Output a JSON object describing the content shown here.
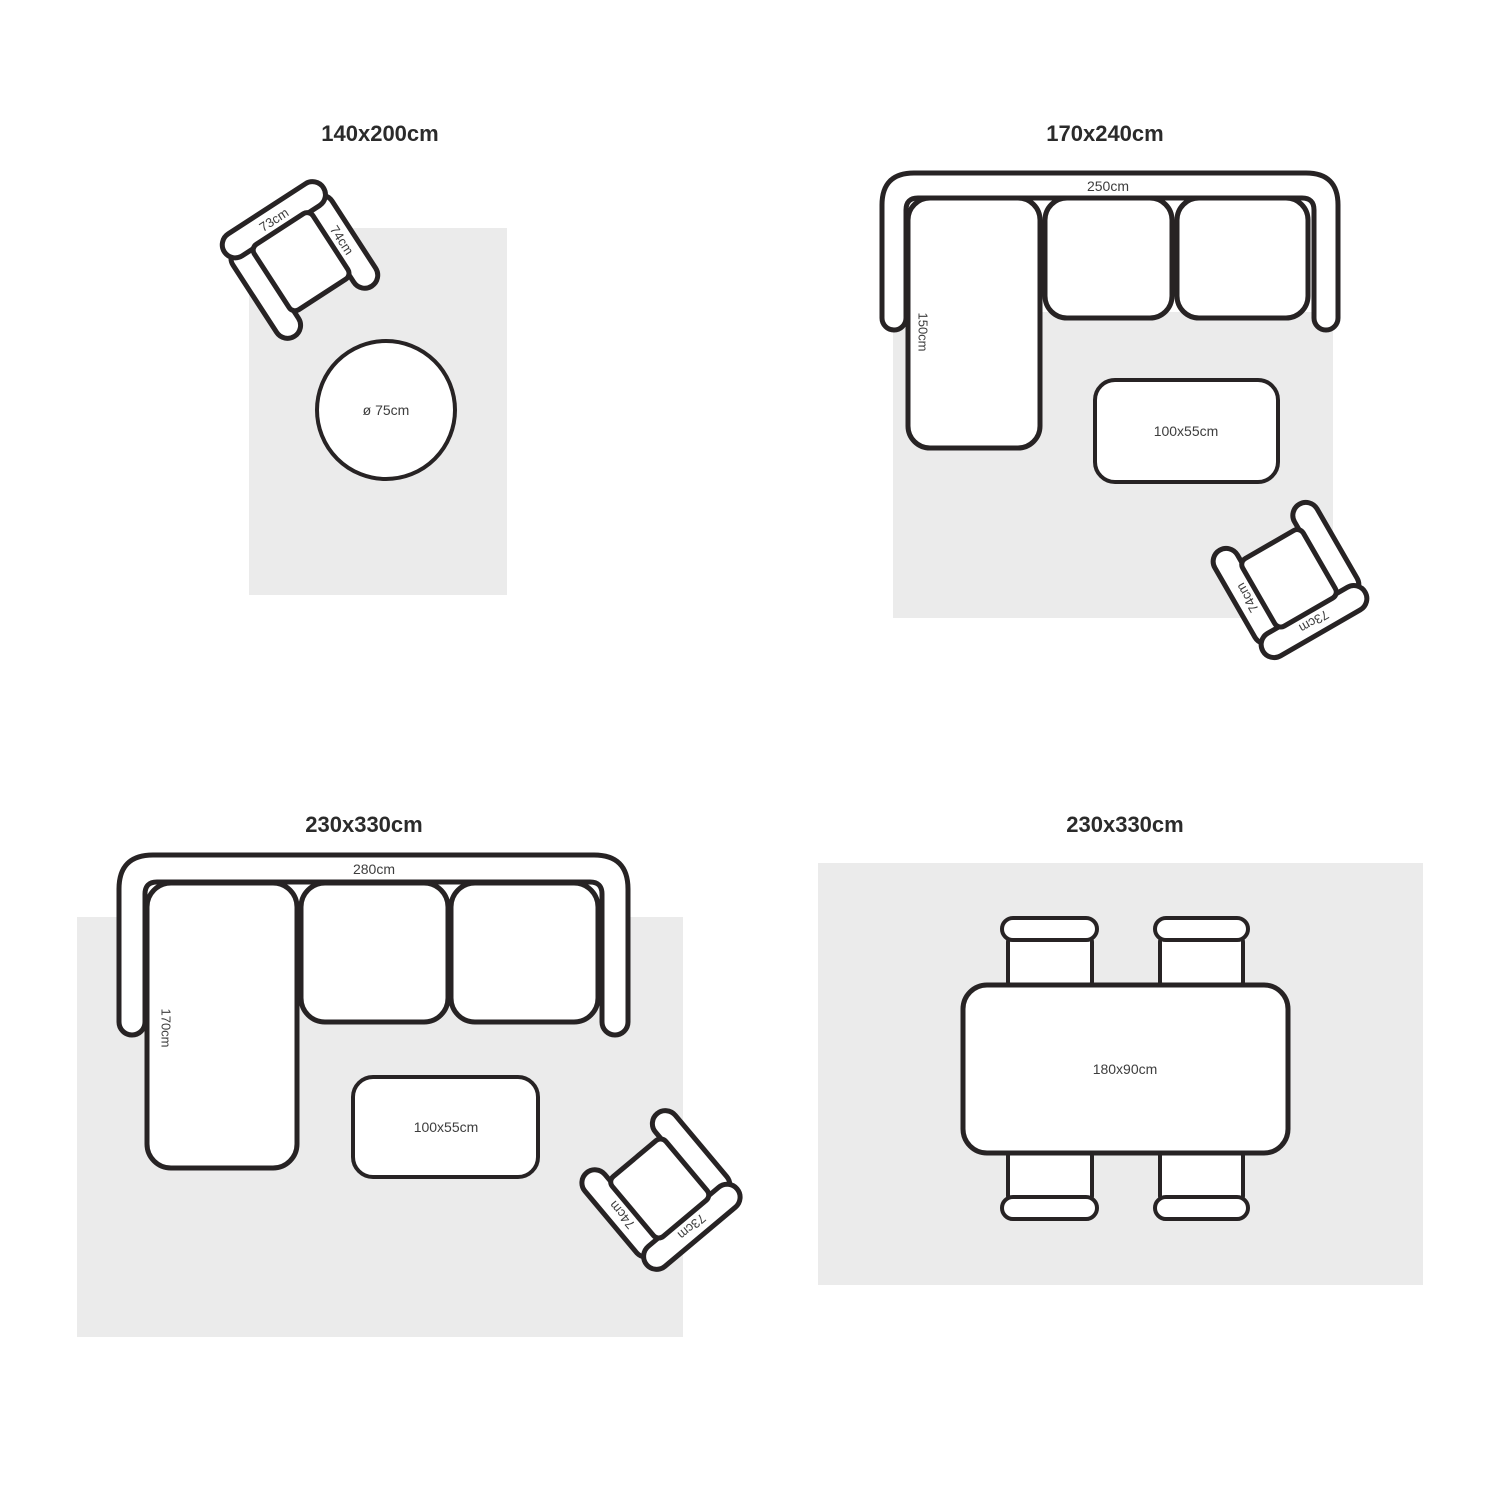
{
  "page": {
    "description": "Rug size guide diagrams with furniture layouts",
    "colors": {
      "background": "#ffffff",
      "rug": "#ebebeb",
      "line": "#272324",
      "label": "#3d3d3d",
      "title": "#2b2b2b"
    }
  },
  "quadrants": [
    {
      "title": "140x200cm",
      "armchair": {
        "back_label": "73cm",
        "arm_label": "74cm"
      },
      "round_table": {
        "label": "ø 75cm"
      }
    },
    {
      "title": "170x240cm",
      "sofa": {
        "width_label": "250cm",
        "chaise_label": "150cm"
      },
      "coffee_table": {
        "label": "100x55cm"
      },
      "armchair": {
        "back_label": "73cm",
        "arm_label": "74cm"
      }
    },
    {
      "title": "230x330cm",
      "sofa": {
        "width_label": "280cm",
        "chaise_label": "170cm"
      },
      "coffee_table": {
        "label": "100x55cm"
      },
      "armchair": {
        "back_label": "73cm",
        "arm_label": "74cm"
      }
    },
    {
      "title": "230x330cm",
      "dining_table": {
        "label": "180x90cm"
      }
    }
  ]
}
